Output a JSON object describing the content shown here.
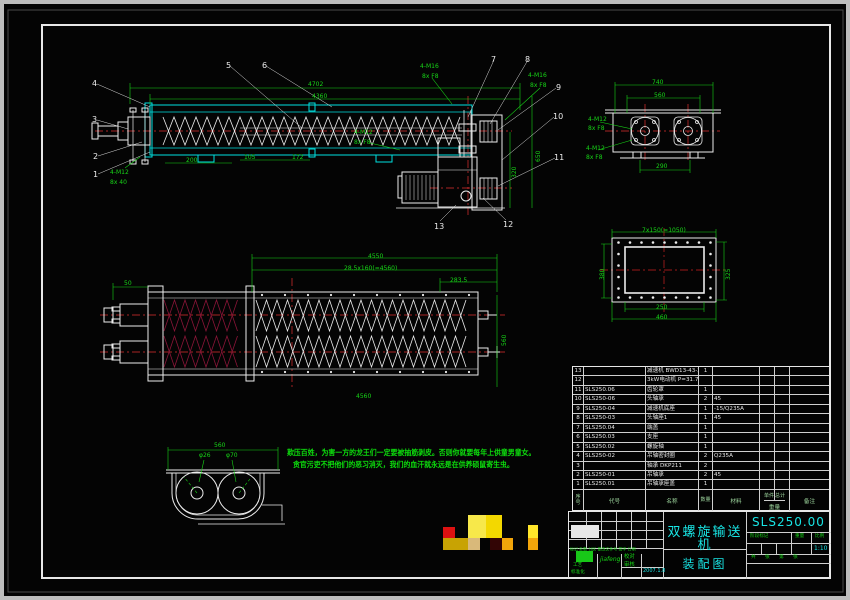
{
  "drawing": {
    "code": "SLS250.00",
    "product_name": "双螺旋输送机",
    "sheet_name": "装配图",
    "scale_value": "1:10"
  },
  "title_block_labels": {
    "stage": "阶段标记",
    "weight": "重量",
    "scale": "比例",
    "sheets": "共 张 第 张",
    "rev_header": "标记 处数 分区 更改文件号 签字 日期"
  },
  "signatures": {
    "sig": "jiafeng",
    "date": "2007.1.8",
    "left1": "工艺",
    "left2": "标准化",
    "mid1": "校对",
    "mid2": "审核"
  },
  "notes": {
    "line1": "欺压百姓，为害一方的龙王们一定要被抽筋剥皮。否则你就要每年上供童男童女。",
    "line2": "贪官污吏不把他们的恶习消灭，我们的血汗就永远是在供养硕鼠寄生虫。"
  },
  "bom": {
    "headers": {
      "no": "序 号",
      "code": "代号",
      "name": "名称",
      "qty": "数量",
      "mat": "材料",
      "unit": "单件",
      "total": "总计",
      "weight": "重量",
      "notes": "备注"
    },
    "rows": [
      {
        "no": "13",
        "code": "",
        "name": "减速机 BWD13-43-2.2",
        "qty": "1",
        "mat": ""
      },
      {
        "no": "12",
        "code": "",
        "name": "3kW电动机 P=31.75",
        "qty": "",
        "mat": ""
      },
      {
        "no": "11",
        "code": "SLS250.06",
        "name": "齿轮罩",
        "qty": "1",
        "mat": ""
      },
      {
        "no": "10",
        "code": "SLS250-06",
        "name": "头轴承",
        "qty": "2",
        "mat": "45"
      },
      {
        "no": "9",
        "code": "SLS250-04",
        "name": "减速机底座",
        "qty": "1",
        "mat": "-15/Q235A"
      },
      {
        "no": "8",
        "code": "SLS250-03",
        "name": "头轴座1",
        "qty": "1",
        "mat": "45"
      },
      {
        "no": "7",
        "code": "SLS250.04",
        "name": "端盖",
        "qty": "1",
        "mat": ""
      },
      {
        "no": "6",
        "code": "SLS250.03",
        "name": "支座",
        "qty": "1",
        "mat": ""
      },
      {
        "no": "5",
        "code": "SLS250.02",
        "name": "螺旋轴",
        "qty": "1",
        "mat": ""
      },
      {
        "no": "4",
        "code": "SLS250-02",
        "name": "吊轴密封圈",
        "qty": "2",
        "mat": "Q235A"
      },
      {
        "no": "3",
        "code": "",
        "name": "轴承 DKP211",
        "qty": "2",
        "mat": ""
      },
      {
        "no": "2",
        "code": "SLS250-01",
        "name": "吊轴承",
        "qty": "2",
        "mat": "45"
      },
      {
        "no": "1",
        "code": "SLS250.01",
        "name": "吊轴承座盖",
        "qty": "1",
        "mat": ""
      }
    ]
  },
  "balloons": [
    {
      "n": "4",
      "x": 92,
      "y": 80
    },
    {
      "n": "3",
      "x": 92,
      "y": 116
    },
    {
      "n": "2",
      "x": 93,
      "y": 153
    },
    {
      "n": "1",
      "x": 93,
      "y": 171
    },
    {
      "n": "5",
      "x": 226,
      "y": 62
    },
    {
      "n": "6",
      "x": 262,
      "y": 62
    },
    {
      "n": "7",
      "x": 491,
      "y": 56
    },
    {
      "n": "8",
      "x": 525,
      "y": 56
    },
    {
      "n": "9",
      "x": 556,
      "y": 84
    },
    {
      "n": "10",
      "x": 553,
      "y": 113
    },
    {
      "n": "11",
      "x": 554,
      "y": 154
    },
    {
      "n": "12",
      "x": 503,
      "y": 221
    },
    {
      "n": "13",
      "x": 434,
      "y": 223
    }
  ],
  "dims": [
    {
      "t": "4702",
      "x": 308,
      "y": 82
    },
    {
      "t": "4360",
      "x": 312,
      "y": 94
    },
    {
      "t": "200",
      "x": 186,
      "y": 158
    },
    {
      "t": "105",
      "x": 244,
      "y": 155
    },
    {
      "t": "172",
      "x": 292,
      "y": 155
    },
    {
      "t": "4-M12",
      "x": 110,
      "y": 170
    },
    {
      "t": "8x 40",
      "x": 110,
      "y": 180
    },
    {
      "t": "4-M16",
      "x": 420,
      "y": 64
    },
    {
      "t": "8x F8",
      "x": 422,
      "y": 74
    },
    {
      "t": "4-M16",
      "x": 528,
      "y": 73
    },
    {
      "t": "8x F8",
      "x": 530,
      "y": 83
    },
    {
      "t": "4-M12",
      "x": 354,
      "y": 130
    },
    {
      "t": "8x F8",
      "x": 354,
      "y": 140
    },
    {
      "t": "320",
      "x": 512,
      "y": 178,
      "rot": 1
    },
    {
      "t": "650",
      "x": 536,
      "y": 162,
      "rot": 1
    },
    {
      "t": "740",
      "x": 652,
      "y": 80
    },
    {
      "t": "560",
      "x": 654,
      "y": 93
    },
    {
      "t": "290",
      "x": 656,
      "y": 164
    },
    {
      "t": "4-M12",
      "x": 588,
      "y": 117
    },
    {
      "t": "8x F8",
      "x": 588,
      "y": 126
    },
    {
      "t": "4-M12",
      "x": 586,
      "y": 146
    },
    {
      "t": "8x F8",
      "x": 586,
      "y": 155
    },
    {
      "t": "7x150(=1050)",
      "x": 642,
      "y": 228
    },
    {
      "t": "380",
      "x": 600,
      "y": 280,
      "rot": 1
    },
    {
      "t": "325",
      "x": 726,
      "y": 280,
      "rot": 1
    },
    {
      "t": "250",
      "x": 656,
      "y": 305
    },
    {
      "t": "460",
      "x": 656,
      "y": 315
    },
    {
      "t": "4550",
      "x": 368,
      "y": 254
    },
    {
      "t": "28.5x160(=4560)",
      "x": 344,
      "y": 266
    },
    {
      "t": "283.5",
      "x": 450,
      "y": 278
    },
    {
      "t": "50",
      "x": 124,
      "y": 281
    },
    {
      "t": "560",
      "x": 502,
      "y": 346,
      "rot": 1
    },
    {
      "t": "4560",
      "x": 356,
      "y": 394
    },
    {
      "t": "560",
      "x": 214,
      "y": 443
    },
    {
      "t": "φ26",
      "x": 199,
      "y": 453
    },
    {
      "t": "φ70",
      "x": 226,
      "y": 453
    }
  ],
  "logo_blocks": [
    {
      "x": 443,
      "y": 527,
      "w": 12,
      "h": 11,
      "c": "#dd1111"
    },
    {
      "x": 468,
      "y": 515,
      "w": 18,
      "h": 23,
      "c": "#f7e84a"
    },
    {
      "x": 486,
      "y": 515,
      "w": 16,
      "h": 23,
      "c": "#f3d800"
    },
    {
      "x": 443,
      "y": 538,
      "w": 25,
      "h": 12,
      "c": "#c8a303"
    },
    {
      "x": 468,
      "y": 538,
      "w": 12,
      "h": 12,
      "c": "#d9b97a"
    },
    {
      "x": 490,
      "y": 538,
      "w": 12,
      "h": 12,
      "c": "#320505"
    },
    {
      "x": 502,
      "y": 538,
      "w": 11,
      "h": 12,
      "c": "#f2a50a"
    },
    {
      "x": 528,
      "y": 525,
      "w": 10,
      "h": 13,
      "c": "#ffe62a"
    },
    {
      "x": 528,
      "y": 538,
      "w": 10,
      "h": 12,
      "c": "#f2a50a"
    }
  ]
}
